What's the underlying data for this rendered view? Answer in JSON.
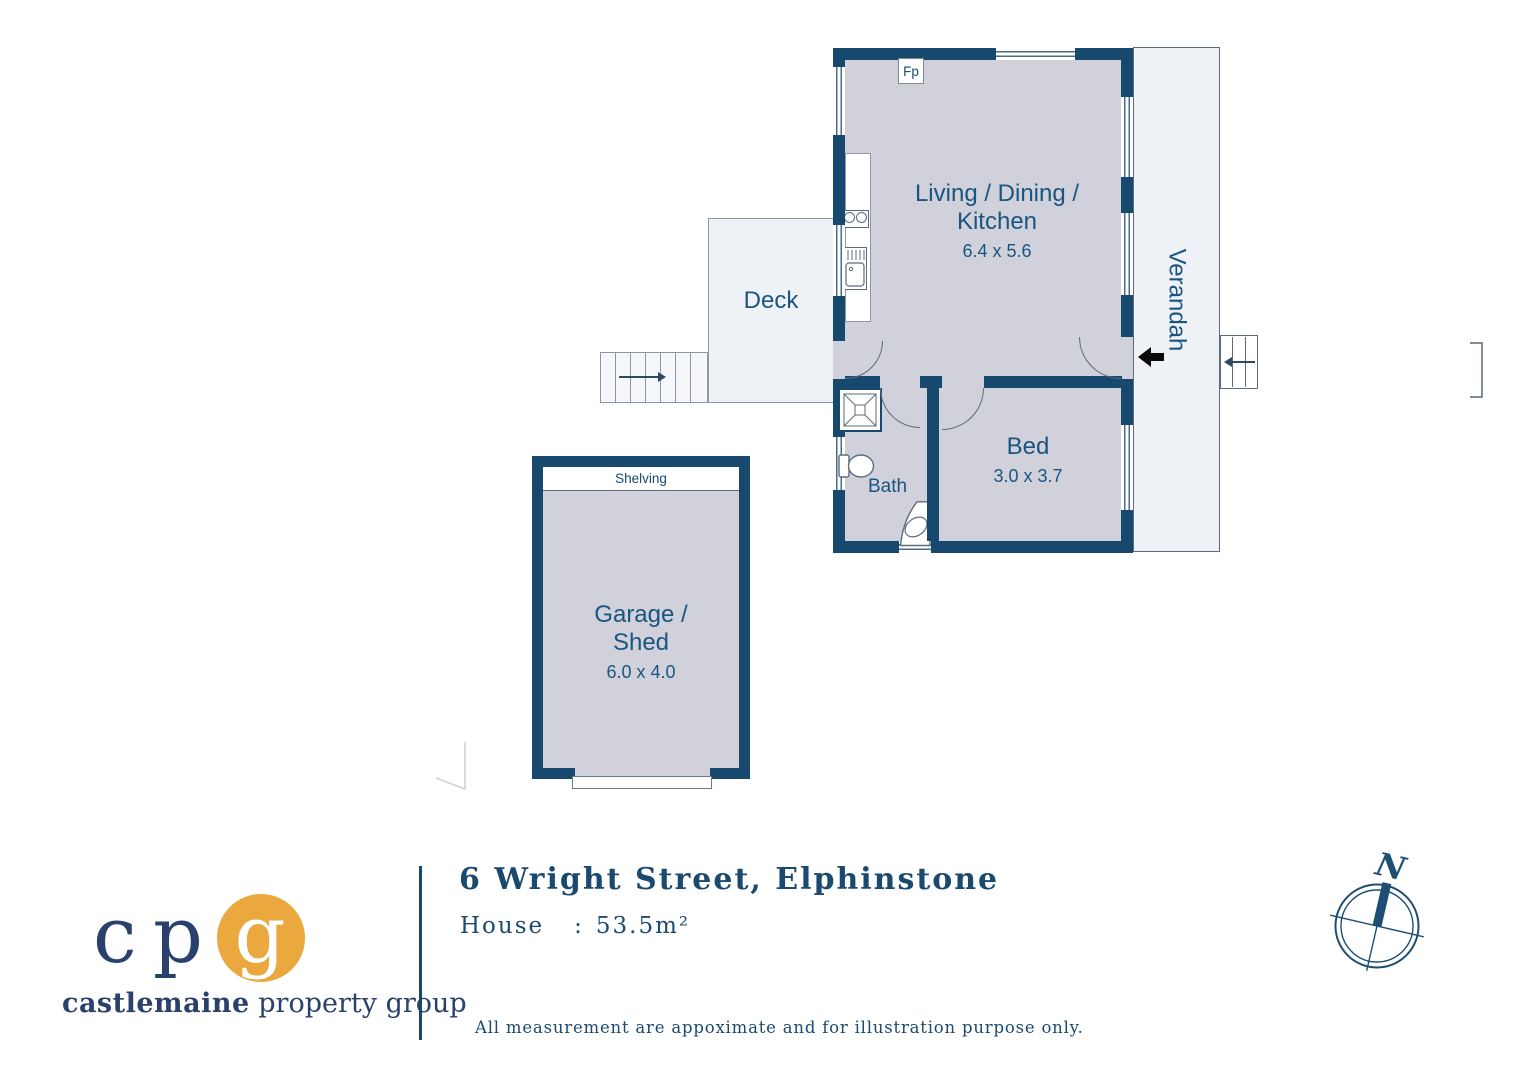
{
  "plan": {
    "living": {
      "line1": "Living / Dining /",
      "line2": "Kitchen",
      "dims": "6.4 x 5.6"
    },
    "bed": {
      "name": "Bed",
      "dims": "3.0 x 3.7"
    },
    "bath": {
      "name": "Bath"
    },
    "deck": {
      "label": "Deck"
    },
    "verandah": {
      "label": "Verandah"
    },
    "garage": {
      "line1": "Garage /",
      "line2": "Shed",
      "dims": "6.0 x 4.0",
      "shelving": "Shelving"
    },
    "fireplace": {
      "label": "Fp"
    }
  },
  "footer": {
    "title": "6 Wright Street, Elphinstone",
    "house_label": "House",
    "house_colon": ":",
    "house_value": "53.5m²",
    "disclaimer": "All measurement are appoximate and for illustration purpose only."
  },
  "logo": {
    "letter_c": "c",
    "letter_p": "p",
    "letter_g": "g",
    "brand_bold": "castlemaine",
    "brand_regular": "property group"
  },
  "compass": {
    "north": "N"
  },
  "colors": {
    "wall_navy": "#17496e",
    "room_fill": "#d1d1dc",
    "outdoor_fill": "#eef1f6",
    "label_navy": "#1a5580",
    "logo_navy": "#2a406d",
    "logo_orange": "#eaa83e",
    "entry_arrow": "#0a0a0a"
  }
}
